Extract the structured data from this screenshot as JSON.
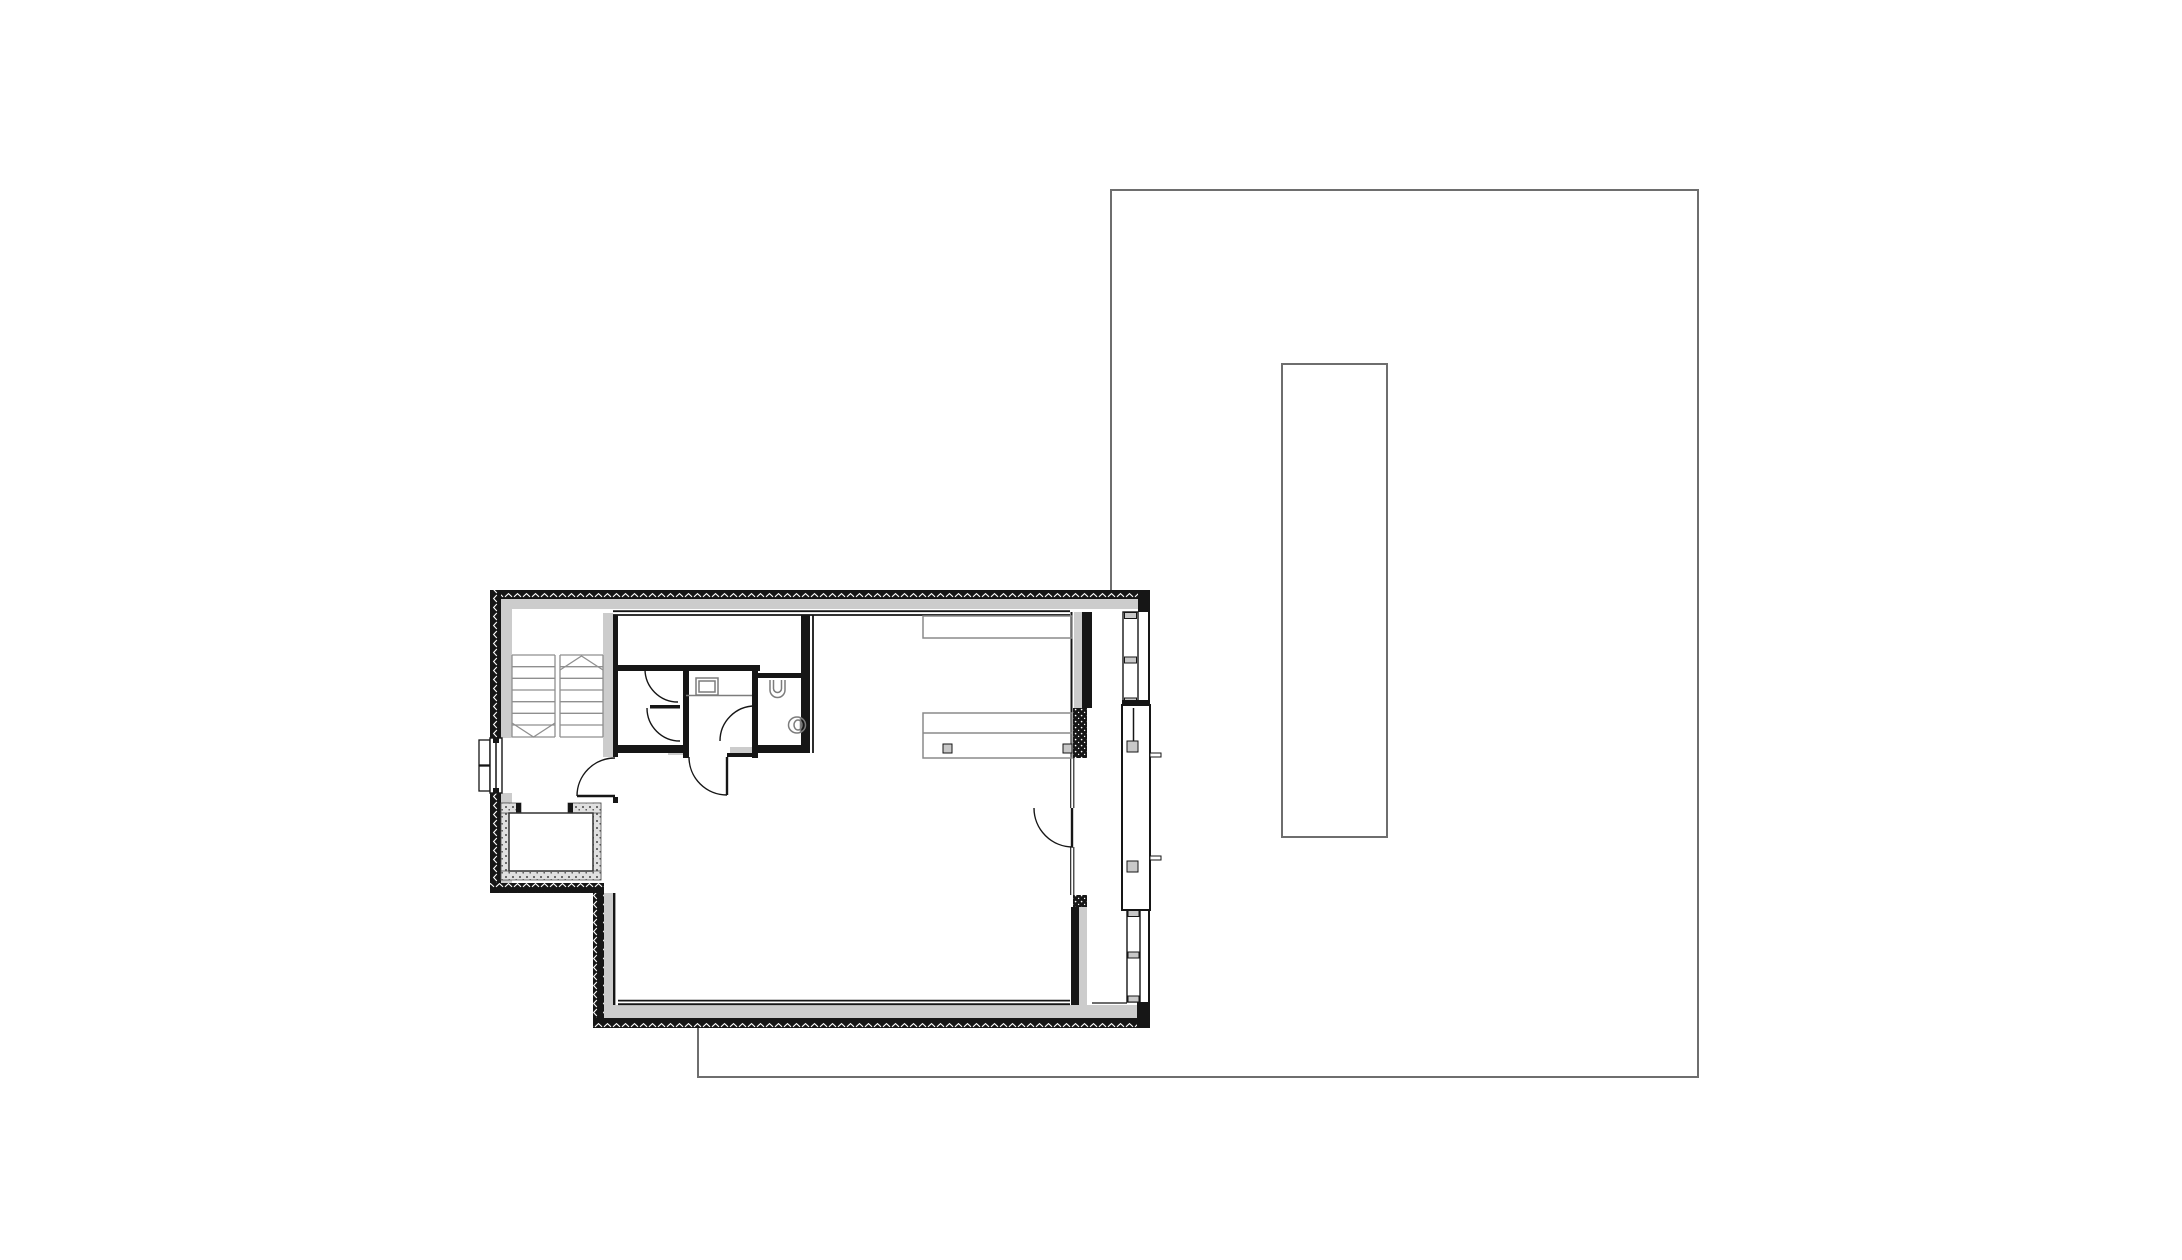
{
  "document": {
    "type": "architectural-floor-plan",
    "sheet": "attic / roof-terrace storey plan",
    "visible_text": "none"
  },
  "canvas": {
    "width": 2182,
    "height": 1260
  },
  "colors": {
    "paper": "#ffffff",
    "wall": "#161616",
    "finish": "#cccccc",
    "stair": "#8f8f8f",
    "furniture": "#8a8a8a",
    "fixture": "#7c7c7c",
    "site": "#6e6e6e",
    "pane": "#c8c8c8",
    "stipple-bg": "#e0e0e0",
    "stipple-dot": "#454545"
  },
  "site": {
    "boundary_path": "M 1111,590 L 1111,190 L 1698,190 L 1698,1077 L 698,1077 L 698,1028",
    "skylight_path": "M 1282,364 h 105 v 473 h -105 Z"
  },
  "building": {
    "outer_outline": "L-shaped dwelling, insulated perimeter walls with hatch, top-left stairwell, bathroom core, open living room, glazed east loggia",
    "stairs": {
      "flights": 2,
      "treads_per_flight": 7,
      "direction_marks": "chevron-up right flight, chevron-down left flight"
    },
    "rooms": [
      "stairwell",
      "hall",
      "corridor",
      "storage-room",
      "shower-room",
      "wc",
      "vestibule",
      "living-room",
      "loggia"
    ],
    "fixtures": [
      "shower-tray",
      "wall-toilet",
      "corner-sink"
    ],
    "furniture": [
      "wardrobe-top",
      "kitchen-counter-with-two-hobs"
    ],
    "doors_with_swing_arcs": 6,
    "shaft": "stippled light-well shaft at lower-left notch"
  }
}
